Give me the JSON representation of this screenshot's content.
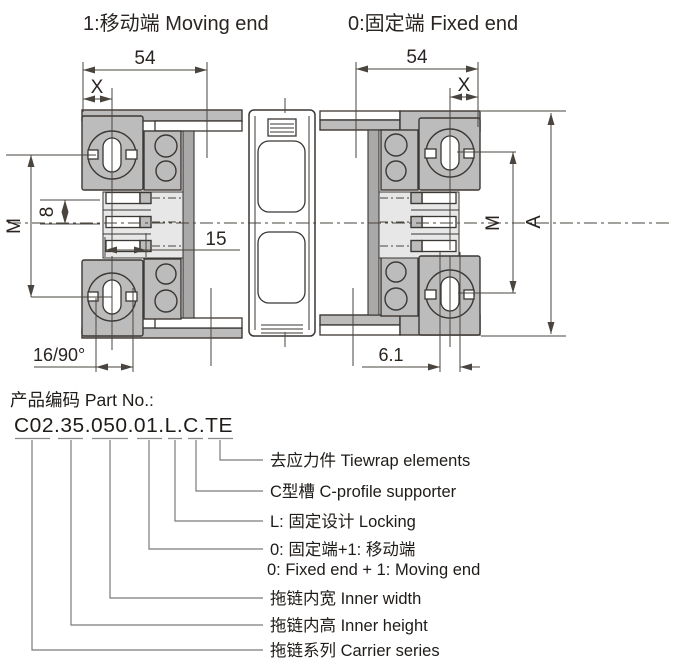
{
  "drawing": {
    "end_labels": {
      "moving": "1:移动端 Moving end",
      "fixed": "0:固定端 Fixed end"
    },
    "dimensions": {
      "width_left": "54",
      "width_right": "54",
      "offset_left": "X",
      "offset_right": "X",
      "mount_left": "M",
      "mount_right": "M",
      "pin_pitch": "8",
      "pin_length": "15",
      "overall": "A",
      "slot_16_90": "16/90°",
      "slot_width": "6.1"
    }
  },
  "part_number": {
    "title": "产品编码 Part No.:",
    "code": "C02.35.050.01.L.C.TE",
    "legend": [
      {
        "segment": "TE",
        "label": "去应力件 Tiewrap elements"
      },
      {
        "segment": "C",
        "label": "C型槽 C-profile supporter"
      },
      {
        "segment": "L",
        "label": "L: 固定设计 Locking"
      },
      {
        "segment": "01",
        "label": "0: 固定端+1: 移动端",
        "label_en": "0: Fixed end + 1: Moving end"
      },
      {
        "segment": "050",
        "label": "拖链内宽 Inner width"
      },
      {
        "segment": "35",
        "label": "拖链内高 Inner height"
      },
      {
        "segment": "C02",
        "label": "拖链系列 Carrier series"
      }
    ]
  },
  "colors": {
    "outline": "#3b3734",
    "dimension_line": "#4a443e",
    "metal_gray": "#bcbcbc",
    "dark_gray": "#a9a9a9",
    "light_gray": "#e7e7e7",
    "leader_gray": "#7a7a7a",
    "text": "#1f1b18",
    "background": "#ffffff"
  }
}
